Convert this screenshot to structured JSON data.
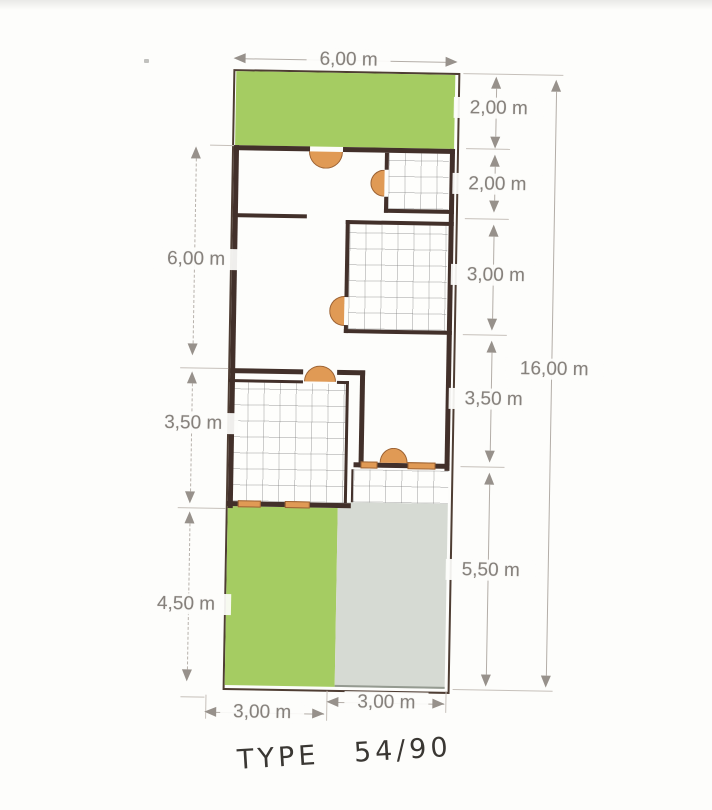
{
  "caption": "TYPE 54/90",
  "dims": {
    "top": "6,00 m",
    "right": [
      "2,00 m",
      "2,00 m",
      "3,00 m",
      "3,50 m",
      "5,50 m"
    ],
    "total_right": "16,00 m",
    "left": [
      "6,00 m",
      "3,50 m",
      "4,50 m"
    ],
    "bottom": [
      "3,00 m",
      "3,00 m"
    ]
  },
  "colors": {
    "yard_green": "#a5cc62",
    "patio_gray": "#d6dad3",
    "door_orange": "#e09a55",
    "wall_dark": "#42302a",
    "dimension_text": "#86817c"
  }
}
